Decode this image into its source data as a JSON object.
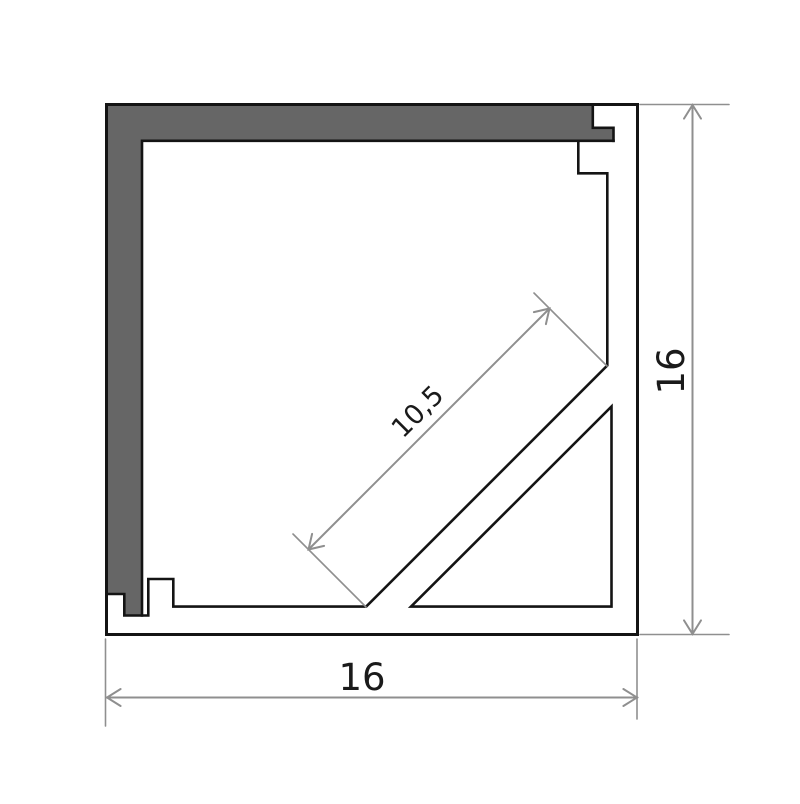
{
  "colors": {
    "background": "#ffffff",
    "outline": "#141414",
    "profile_fill": "#666666",
    "dimension": "#8f8f8f",
    "label": "#1a1a1a"
  },
  "labels": {
    "bottom_width": "16",
    "right_height": "16",
    "diagonal_face_width": "10,5"
  }
}
